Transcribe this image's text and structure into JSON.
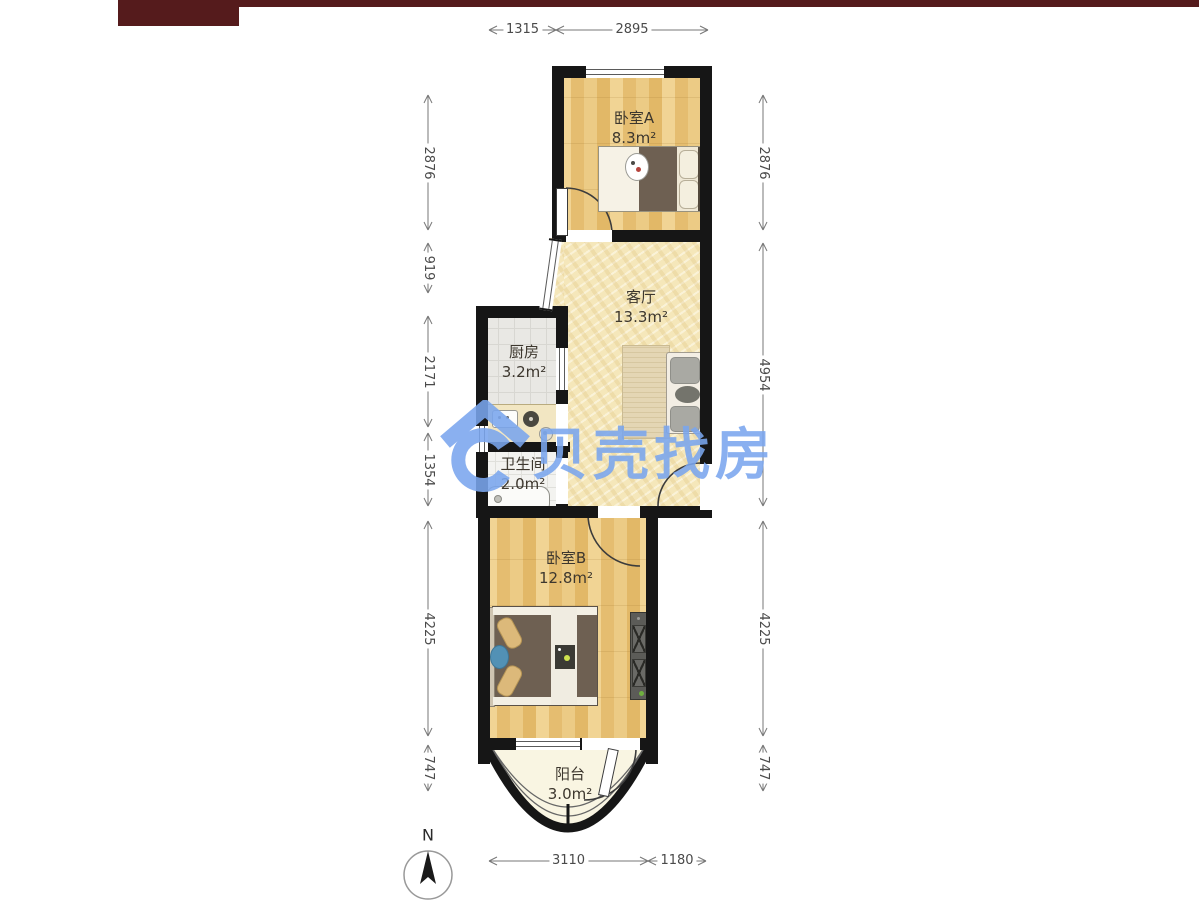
{
  "header": {
    "bar_color": "#551b1c"
  },
  "watermark": {
    "text": "贝壳找房",
    "logo": "beike-house-logo",
    "color": "#7aa6ee"
  },
  "compass": {
    "label": "N"
  },
  "rooms": [
    {
      "id": "bedroom-a",
      "name": "卧室A",
      "area": "8.3m²"
    },
    {
      "id": "living-room",
      "name": "客厅",
      "area": "13.3m²"
    },
    {
      "id": "kitchen",
      "name": "厨房",
      "area": "3.2m²"
    },
    {
      "id": "bathroom",
      "name": "卫生间",
      "area": "2.0m²"
    },
    {
      "id": "bedroom-b",
      "name": "卧室B",
      "area": "12.8m²"
    },
    {
      "id": "balcony",
      "name": "阳台",
      "area": "3.0m²"
    }
  ],
  "dimensions": {
    "top": [
      "1315",
      "2895"
    ],
    "bottom": [
      "3110",
      "1180"
    ],
    "left": [
      "2876",
      "919",
      "2171",
      "1354",
      "4225",
      "747"
    ],
    "right": [
      "2876",
      "4954",
      "4225",
      "747"
    ]
  }
}
